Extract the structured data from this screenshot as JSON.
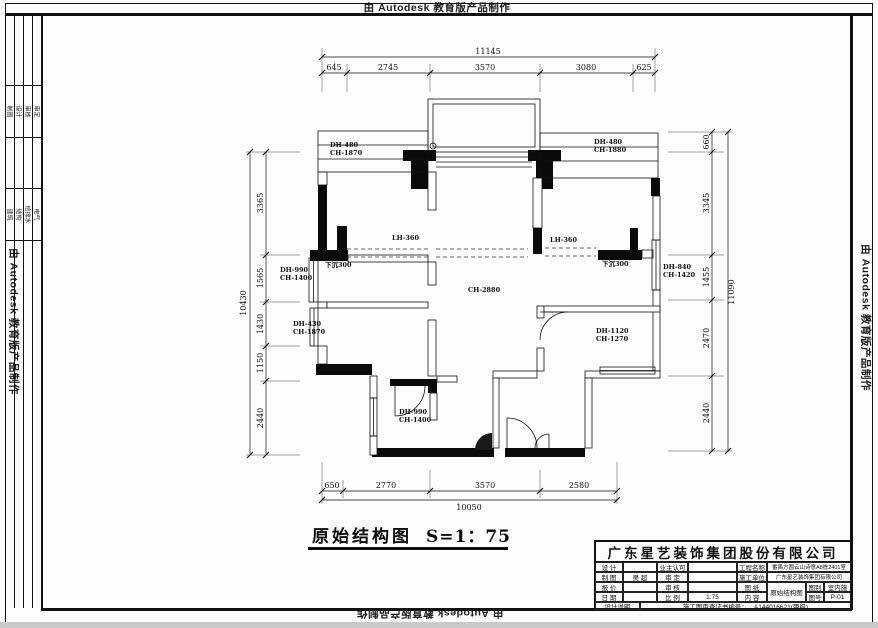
{
  "frame": {
    "watermark_top": "由 Autodesk 教育版产品制作",
    "watermark_bottom": "由 Autodesk 教育版产品制作",
    "watermark_left": "由 Autodesk 教育版产品制作",
    "watermark_right": "由 Autodesk 教育版产品制作",
    "sign_strip": {
      "group1": [
        "制图",
        "设计",
        "审核",
        "审定"
      ],
      "group2": [
        "建筑",
        "结构",
        "给排水",
        "电气"
      ]
    }
  },
  "plan": {
    "title": "原始结构图",
    "scale": "S=1：75",
    "dims": {
      "top": {
        "overall": "11145",
        "segments": [
          "645",
          "2745",
          "3570",
          "3080",
          "625"
        ]
      },
      "bottom": {
        "overall": "10050",
        "segments": [
          "650",
          "2770",
          "3570",
          "2580"
        ]
      },
      "left": {
        "overall": "10430",
        "segments": [
          "3365",
          "1565",
          "1430",
          "1150",
          "2440"
        ]
      },
      "right": {
        "overall": "11090",
        "segments": [
          "660",
          "3345",
          "1455",
          "2470",
          "2440"
        ]
      }
    },
    "labels": [
      {
        "l1": "DH-480",
        "l2": "CH-1870"
      },
      {
        "l1": "DH-480",
        "l2": "CH-1880"
      },
      {
        "l1": "DH-990",
        "l2": "CH-1400"
      },
      {
        "l1": "下沉300"
      },
      {
        "l1": "LH-360"
      },
      {
        "l1": "LH-360"
      },
      {
        "l1": "下沉300"
      },
      {
        "l1": "DH-840",
        "l2": "CH-1420"
      },
      {
        "l1": "CH-2880"
      },
      {
        "l1": "DH-430",
        "l2": "CH-1870"
      },
      {
        "l1": "DH-1120",
        "l2": "CH-1270"
      },
      {
        "l1": "DH-990",
        "l2": "CH-1400"
      }
    ]
  },
  "title_block": {
    "company": "广东星艺装饰集团股份有限公司",
    "design_label": "设 计",
    "owner_label": "业主认可",
    "project_label": "工程名称",
    "project_value": "番禺方圆云山诗意A8栋2401室",
    "draft_label": "制 图",
    "draft_value": "吴 超",
    "approve_label": "审 定",
    "contractor_label": "施工单位",
    "contractor_value": "广东星艺装饰集团有限公司",
    "quote_label": "报 价",
    "check_label": "审 核",
    "sheet_label": "图 纸",
    "content_label": "内 容",
    "drawing_name": "原始结构图",
    "category_label": "图别",
    "category_value": "室内施",
    "number_label": "图号",
    "number_value": "P-01",
    "date_label": "日 期",
    "scale_label": "比 例",
    "scale_value": "1:75",
    "notes_label": "设计说明",
    "cert_label": "施工图审查证书编号：",
    "cert_value": "A144016621(甲级)"
  }
}
